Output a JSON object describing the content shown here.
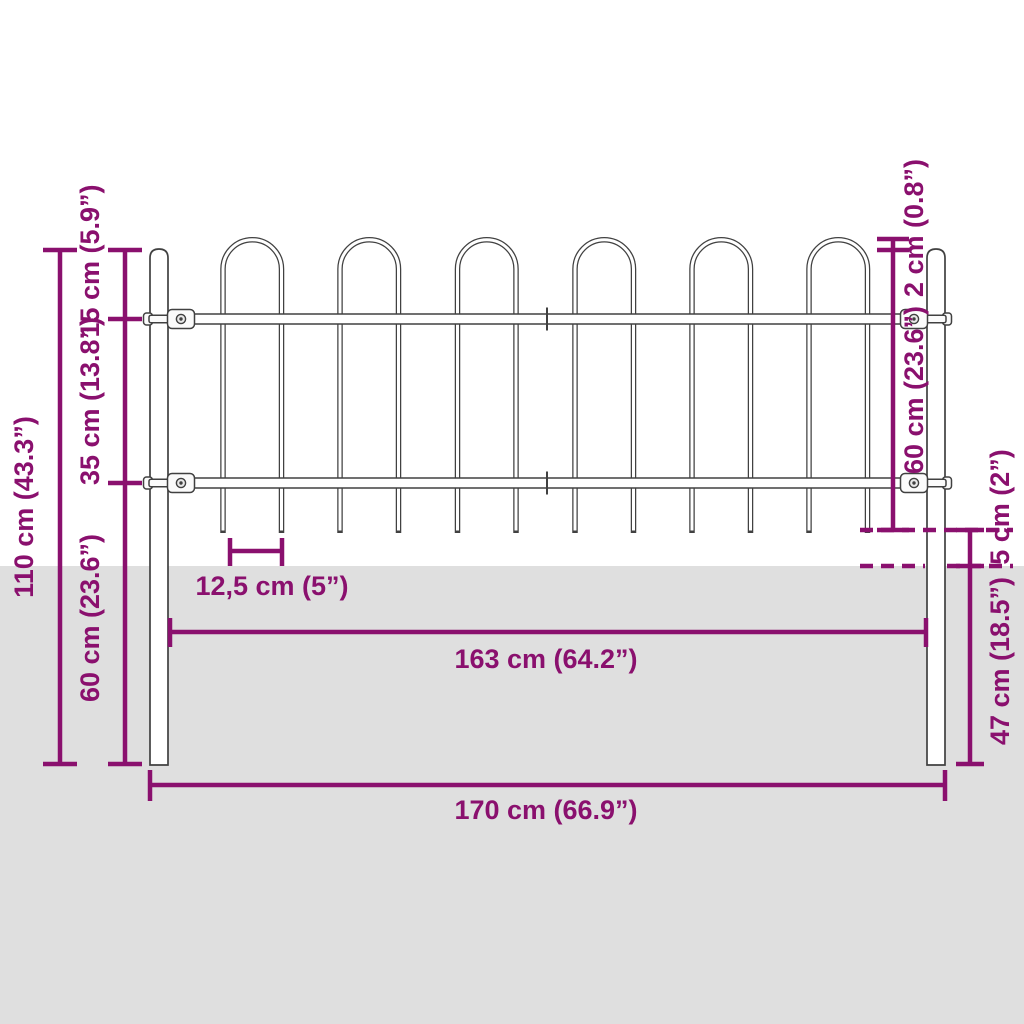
{
  "colors": {
    "accent": "#8a106e",
    "outline": "#414141",
    "ground": "#dfdfdf",
    "background": "#ffffff"
  },
  "labels": {
    "height_total": "110 cm (43.3”)",
    "height_hoop_to_top_rail": "15 cm (5.9”)",
    "height_between_rails": "35 cm (13.8”)",
    "height_bottom_rail_to_post_base": "60 cm (23.6”)",
    "hoop_overhang": "2 cm (0.8”)",
    "panel_height": "60 cm (23.6”)",
    "gap_bars_to_ground": "5 cm (2”)",
    "post_depth_below_ground": "47 cm (18.5”)",
    "bar_spacing": "12,5 cm (5”)",
    "width_between_posts": "163 cm (64.2”)",
    "width_total": "170 cm (66.9”)"
  }
}
